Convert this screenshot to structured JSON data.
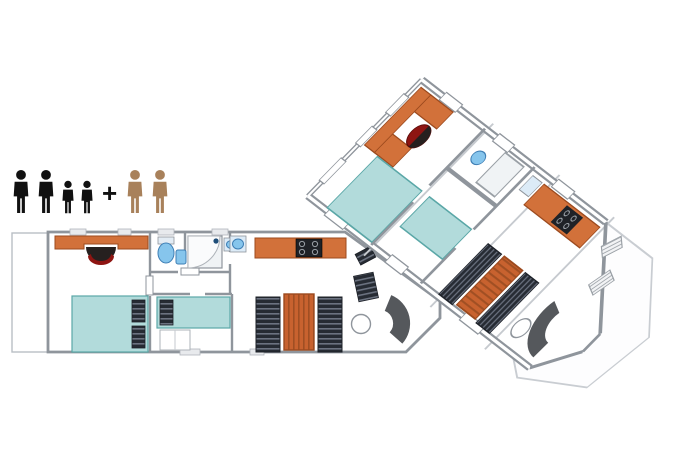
{
  "capacity": {
    "black_adults": 2,
    "black_children": 2,
    "plus_label": "+",
    "brown_adults": 2
  },
  "colors": {
    "background": "#ffffff",
    "wall": "#8f959c",
    "wall_light": "#c6cacf",
    "furniture_orange": "#d2713a",
    "furniture_orange_dark": "#9c4a1e",
    "table_orange": "#c8622f",
    "bed_teal": "#b2dbdb",
    "bed_teal_stroke": "#5aa7a7",
    "fixture_blue": "#86c5ec",
    "fixture_blue_stroke": "#3f7fb5",
    "bench_dark": "#262b33",
    "bench_stripe": "#6b7280",
    "chair_red": "#8e1512",
    "chair_dark": "#26201f",
    "sofa_gray": "#55585c",
    "people_black": "#111111",
    "people_brown": "#a8815b"
  },
  "plan2d": {
    "rooms": [
      {
        "name": "entry-deck",
        "furniture": [
          "door-swing"
        ]
      },
      {
        "name": "master-bedroom",
        "furniture": [
          "wardrobe-desk",
          "desk-chair",
          "double-bed",
          "pillows"
        ]
      },
      {
        "name": "bathroom",
        "furniture": [
          "toilet",
          "washbasin",
          "shower-cabin",
          "washbasin-2"
        ]
      },
      {
        "name": "second-bedroom",
        "furniture": [
          "single-bed",
          "pillow",
          "storage-steps"
        ]
      },
      {
        "name": "kitchen",
        "furniture": [
          "sink",
          "kitchen-counter",
          "hob"
        ]
      },
      {
        "name": "dining-area",
        "furniture": [
          "bench-seat-left",
          "dining-table",
          "bench-seat-right"
        ]
      },
      {
        "name": "front-lounge",
        "furniture": [
          "side-chair",
          "bench-seat-small",
          "round-table",
          "curved-sofa"
        ]
      }
    ]
  },
  "view3d": {
    "name": "isometric-cutaway-view",
    "rooms": [
      {
        "name": "master-bedroom",
        "furniture": [
          "wardrobe-u",
          "desk-chair",
          "double-bed"
        ]
      },
      {
        "name": "bathroom",
        "furniture": [
          "shower-cabin",
          "toilet"
        ]
      },
      {
        "name": "second-bedroom",
        "furniture": [
          "single-bed"
        ]
      },
      {
        "name": "kitchen",
        "furniture": [
          "kitchen-counter",
          "hob",
          "sink"
        ]
      },
      {
        "name": "dining-area",
        "furniture": [
          "bench-seat-left",
          "dining-table",
          "bench-seat-right"
        ]
      },
      {
        "name": "front-lounge",
        "furniture": [
          "curved-sofa",
          "round-table"
        ]
      },
      {
        "name": "outdoor-deck",
        "furniture": [
          "deck-chair-1",
          "deck-chair-2"
        ]
      }
    ]
  }
}
